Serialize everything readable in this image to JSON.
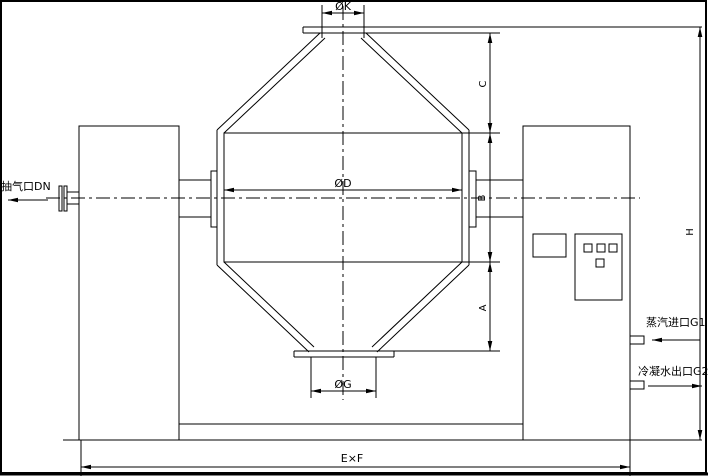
{
  "drawing": {
    "type": "double-cone rotary vacuum dryer outline drawing",
    "background_color": "#ffffff",
    "line_color": "#000000",
    "labels": {
      "top_port_dia": "ØK",
      "vessel_dia": "ØD",
      "bottom_port_dia": "ØG",
      "cone_top_height": "C",
      "cylinder_height": "B",
      "cone_bottom_height": "A",
      "total_height": "H",
      "base_size": "E×F",
      "vacuum_port": "抽气口DN",
      "steam_inlet": "蒸汽进口G1",
      "condensate_outlet": "冷凝水出口G2"
    }
  }
}
